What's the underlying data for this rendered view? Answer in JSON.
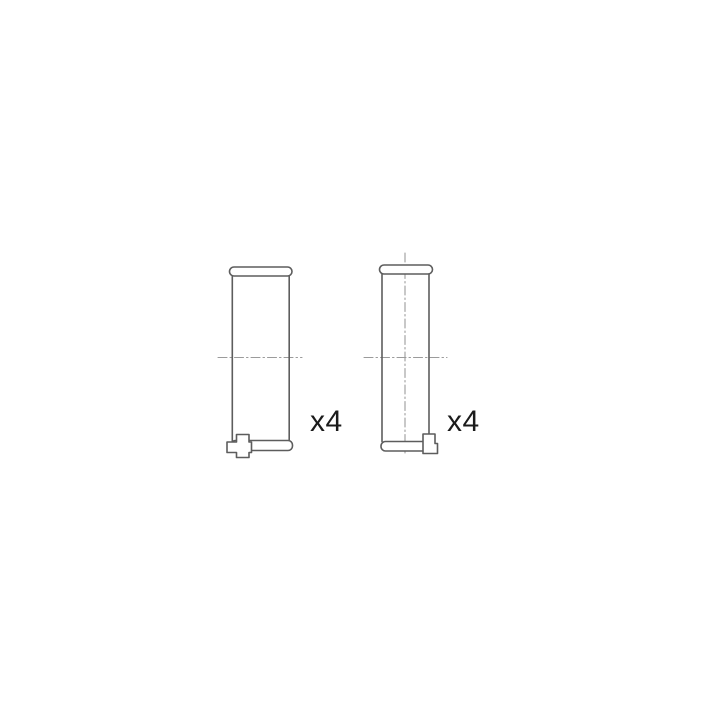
{
  "page": {
    "background_color": "#ffffff"
  },
  "diagram": {
    "kind": "technical-parts-drawing",
    "description": "Side views of two engine bearing shells with locating lugs, each marked with quantity x4",
    "colors": {
      "outline": "#5d5d5d",
      "centerline": "#9b9b9b",
      "label": "#1b1b1b",
      "fill": "#ffffff"
    },
    "parts": [
      {
        "id": "bearing-shell-left",
        "lug_position": "bottom-left",
        "quantity_label": "x4"
      },
      {
        "id": "bearing-shell-right",
        "lug_position": "bottom-right",
        "quantity_label": "x4"
      }
    ]
  }
}
